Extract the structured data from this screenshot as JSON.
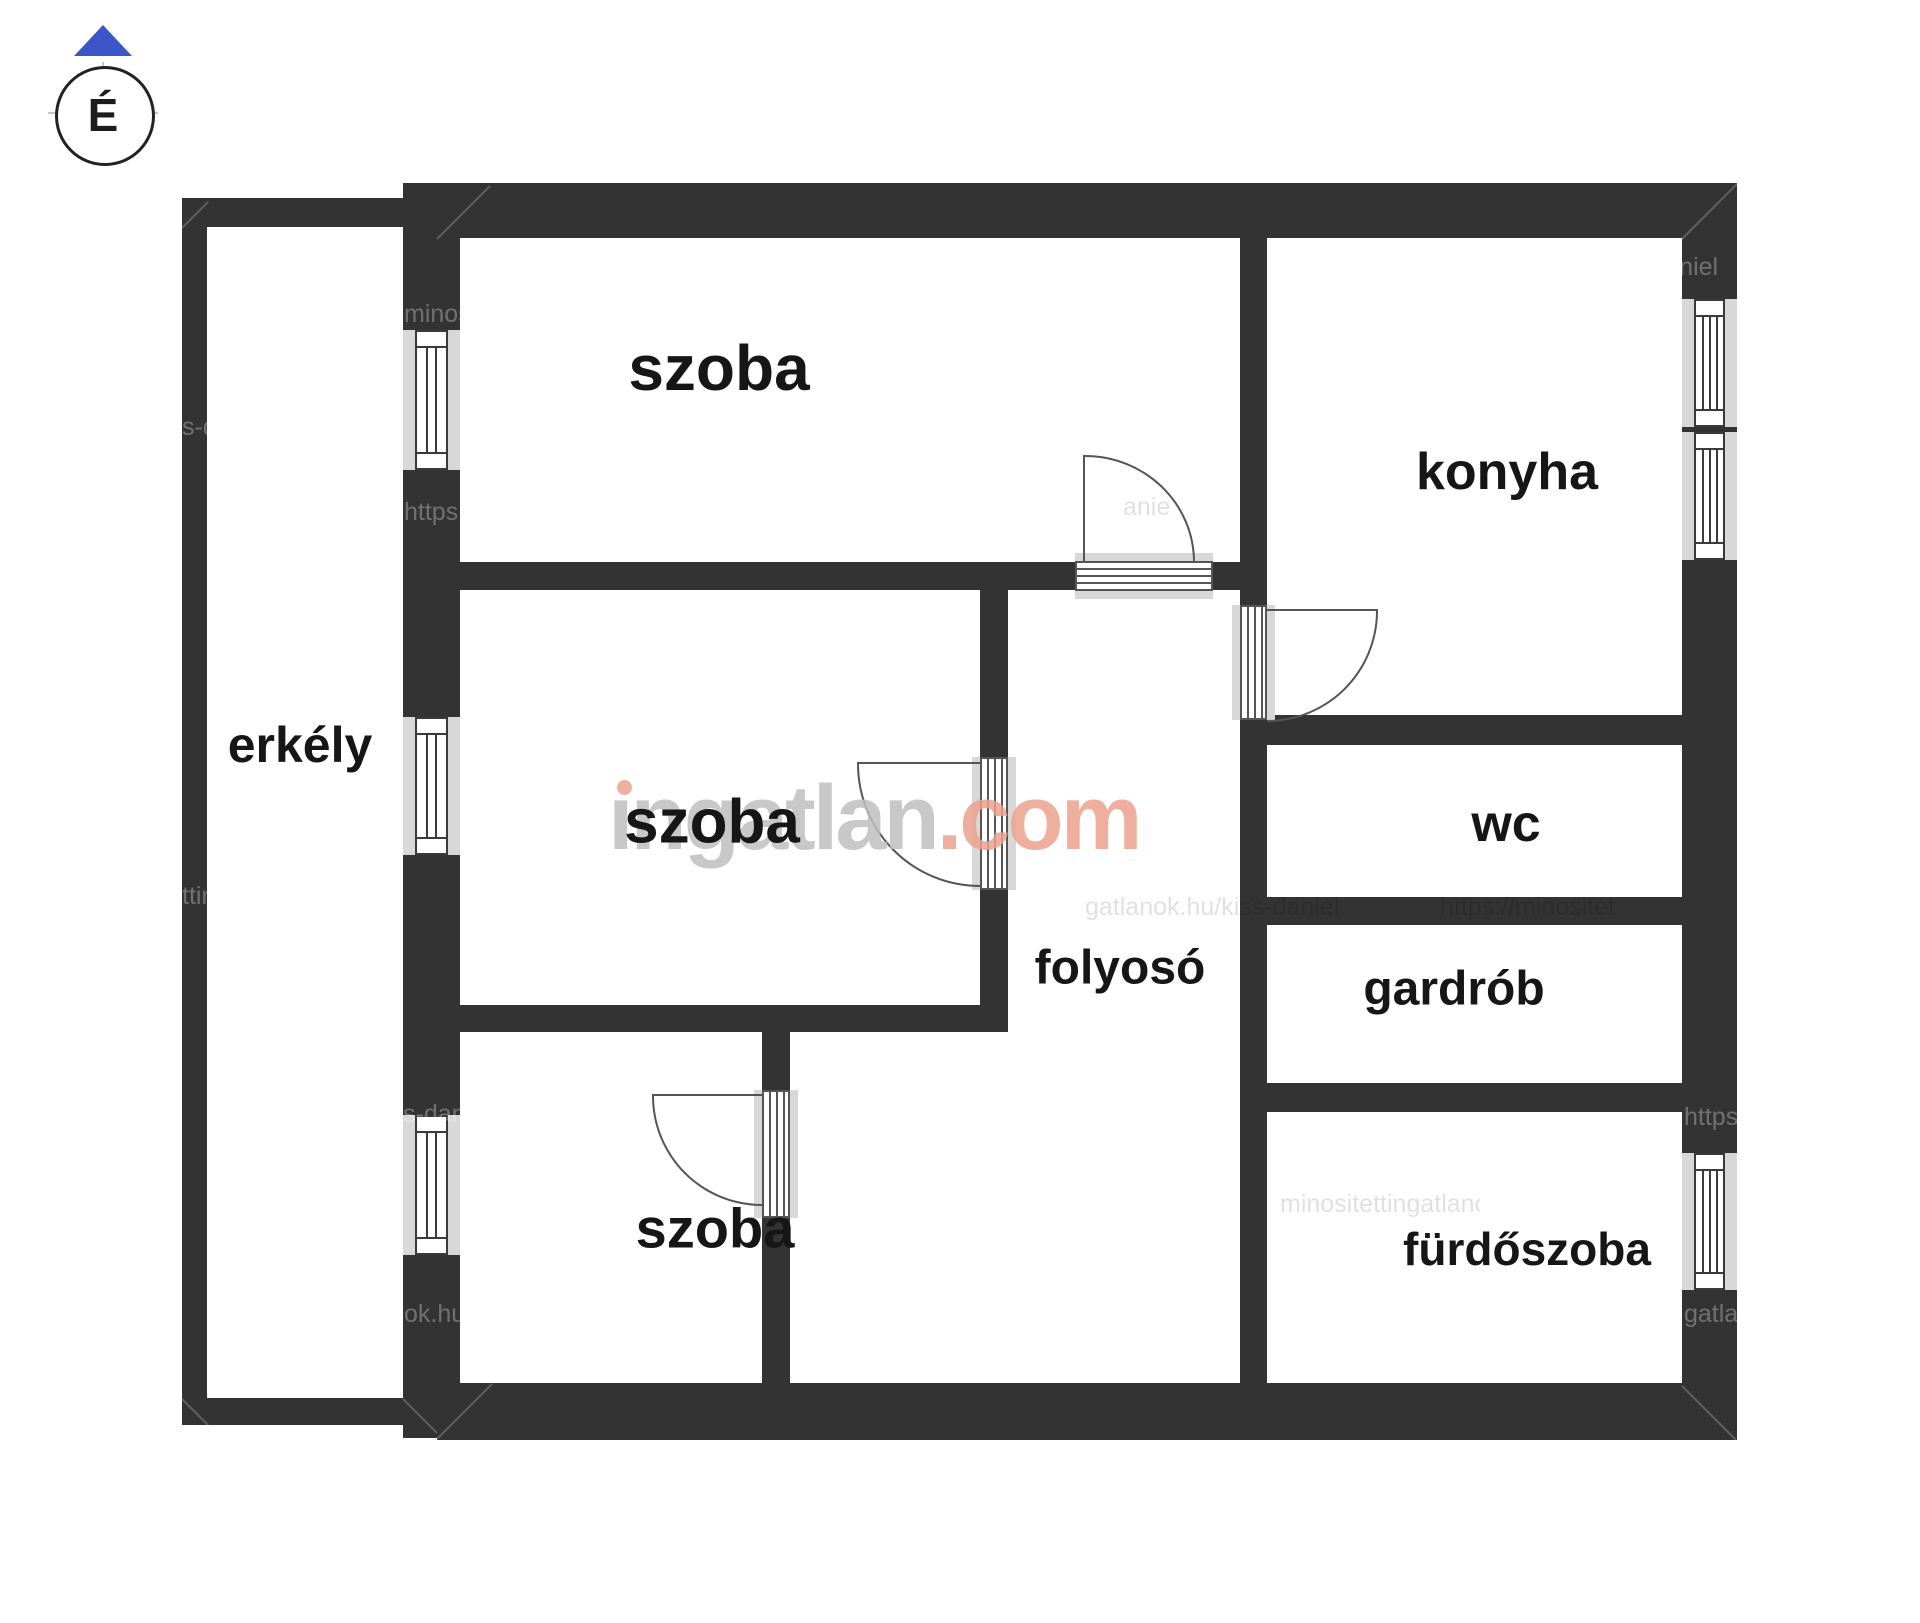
{
  "document": {
    "type": "apartment floor plan"
  },
  "compass": {
    "label": "É"
  },
  "rooms": [
    {
      "id": "szoba-felso",
      "label": "szoba"
    },
    {
      "id": "konyha",
      "label": "konyha"
    },
    {
      "id": "erkely",
      "label": "erkély"
    },
    {
      "id": "szoba-kozepso",
      "label": "szoba"
    },
    {
      "id": "szoba-also",
      "label": "szoba"
    },
    {
      "id": "folyoso",
      "label": "folyosó"
    },
    {
      "id": "wc",
      "label": "wc"
    },
    {
      "id": "gardrob",
      "label": "gardrób"
    },
    {
      "id": "furdoszoba",
      "label": "fürdőszoba"
    }
  ],
  "logo": {
    "text": "ingatlan.com",
    "gray_part": "ıngatlan",
    "accent_part": ".com"
  },
  "watermarks": {
    "items": [
      {
        "text": "minosit"
      },
      {
        "text": "https:"
      },
      {
        "text": "s-danie"
      },
      {
        "text": "ok.hu/"
      },
      {
        "text": "tting"
      },
      {
        "text": "s-da"
      },
      {
        "text": "https://"
      },
      {
        "text": "gatlano"
      },
      {
        "text": "kiss-daniel"
      },
      {
        "text": "gatlanok.hu/kiss-daniel"
      },
      {
        "text": "https://minositet"
      },
      {
        "text": "anie"
      },
      {
        "text": "minositettingatlanok.hu"
      }
    ]
  },
  "colors": {
    "wall": "#333333",
    "window_sill": "#d8d8d8",
    "logo_gray": "#bfbfbf",
    "logo_accent": "#eda28e",
    "compass_blue": "#3c55c8",
    "label_text": "#161616"
  }
}
